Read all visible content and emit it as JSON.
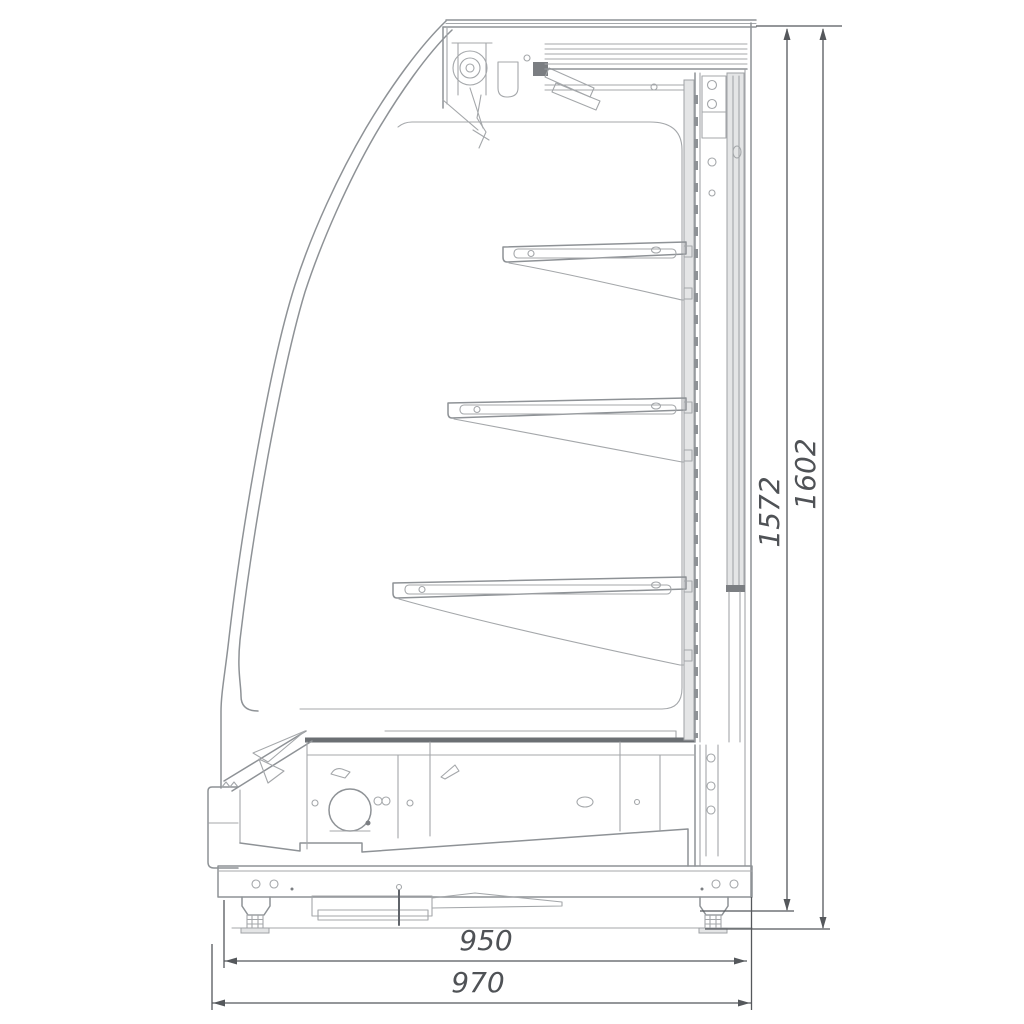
{
  "drawing": {
    "labels": {
      "height_inner": "1572",
      "height_overall": "1602",
      "depth_inner": "950",
      "depth_overall": "970"
    },
    "colors": {
      "background": "#ffffff",
      "line": "#8e9296",
      "line_dark": "#60646a",
      "dimension": "#4f5256",
      "panel_fill": "#e4e5e6",
      "cap_fill": "#7b7e82"
    }
  }
}
